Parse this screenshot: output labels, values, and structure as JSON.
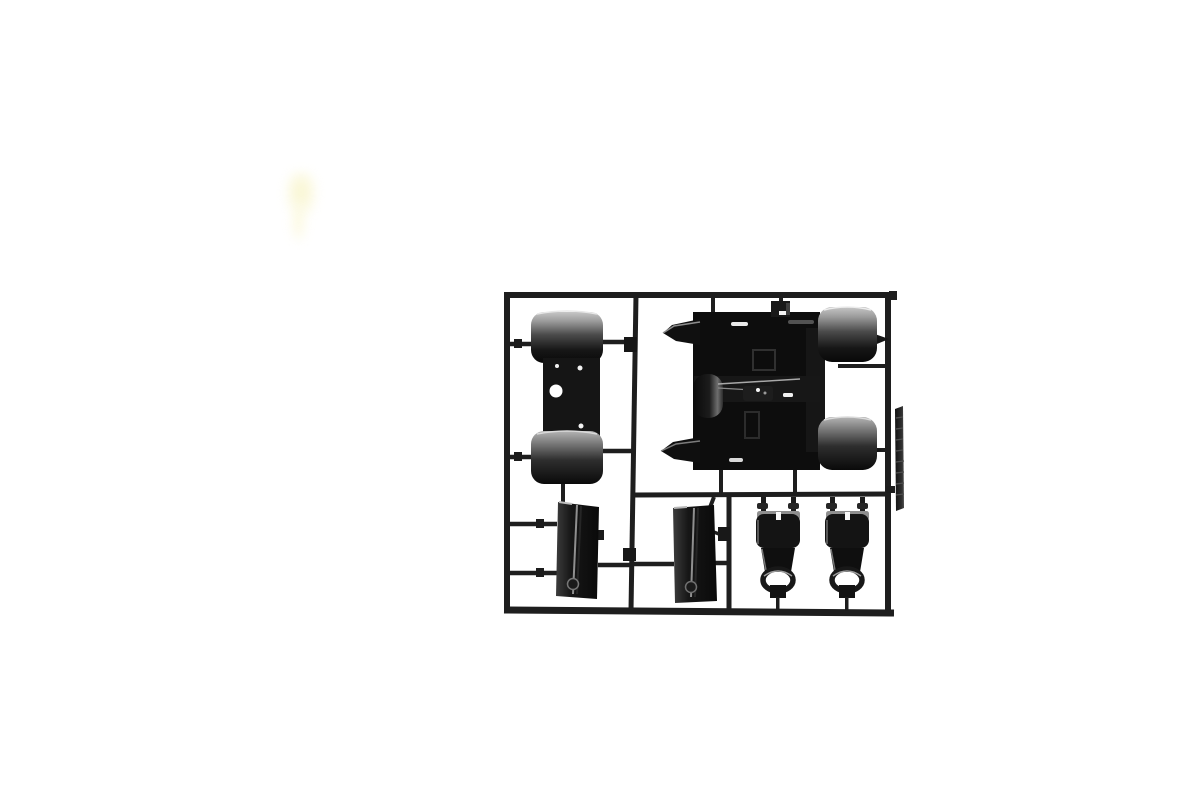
{
  "meta": {
    "description": "Product photograph of a black plastic model kit sprue (parts runner) on a plain white background. The rectangular runner frame holds: a twin-fender unit with a drilled mounting plate (top left), a large cab-floor assembly with two rounded fenders and pointed side wings (top right), two flat door panels (bottom left and bottom middle), two seat-belt buckle parts with D-rings (bottom right), a small bracket near the top, and a narrow textured strip outside the right rail. A faint pale-yellow smudge artifact appears near the upper left of the photo."
  },
  "colors": {
    "background": "#ffffff",
    "runner-dark": "#1e1e1e",
    "plastic-dark": "#111111",
    "plastic-deep": "#0a0a0a",
    "plastic-mid": "#2e2e2e",
    "highlight-gray": "#c2c2c2",
    "highlight-white": "#ececec",
    "smudge-yellow": "#f7f3c4"
  },
  "parts": [
    {
      "id": "sprue-frame",
      "label": "Sprue runner frame with dividers"
    },
    {
      "id": "fender-unit",
      "label": "Twin rounded fenders joined by a drilled mounting plate"
    },
    {
      "id": "cab-floor",
      "label": "Cab floor assembly with two rounded fenders, side wings and gear linkage detail"
    },
    {
      "id": "door-panel-left",
      "label": "Flat door panel with center ridge and bottom boss (left)"
    },
    {
      "id": "door-panel-middle",
      "label": "Flat door panel with center ridge and bottom boss (middle)"
    },
    {
      "id": "buckle-left",
      "label": "Seat-belt buckle part with D-ring (left)"
    },
    {
      "id": "buckle-right",
      "label": "Seat-belt buckle part with D-ring (right)"
    },
    {
      "id": "small-bracket",
      "label": "Small slotted bracket on top runner"
    },
    {
      "id": "tread-strip",
      "label": "Narrow textured strip outside right rail"
    },
    {
      "id": "runners",
      "label": "Connecting runners, gates and tabs"
    },
    {
      "id": "smudge",
      "label": "Faint pale-yellow smudge artifact"
    }
  ]
}
